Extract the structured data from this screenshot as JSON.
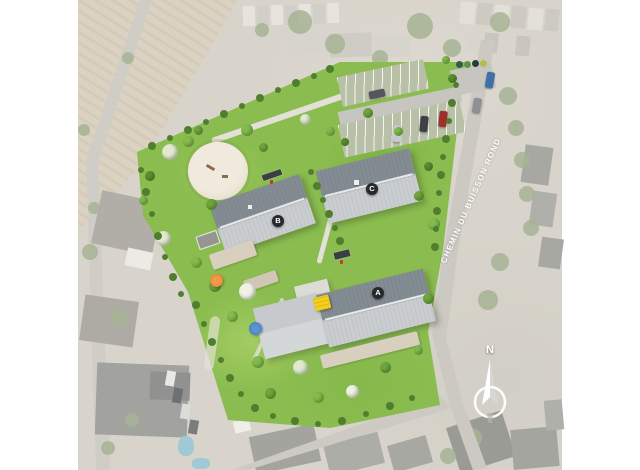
{
  "plan": {
    "road": {
      "label": "CHEMIN DU BUISSON ROND"
    },
    "compass": {
      "label": "N"
    },
    "buildings": [
      {
        "label": "A"
      },
      {
        "label": "B"
      },
      {
        "label": "C"
      }
    ],
    "colors": {
      "site_green": "#8abc4f",
      "roof_dark": "#848c93",
      "roof_light": "#c9cdd0",
      "marker_bg": "#26292c",
      "road_gray": "#ccc9c2",
      "road_text": "#ffffff",
      "accent_yellow": "#f3cf1e",
      "accent_orange": "#e07b28",
      "accent_blue": "#3a77b8",
      "pool_blue": "#9fc9d3"
    }
  }
}
